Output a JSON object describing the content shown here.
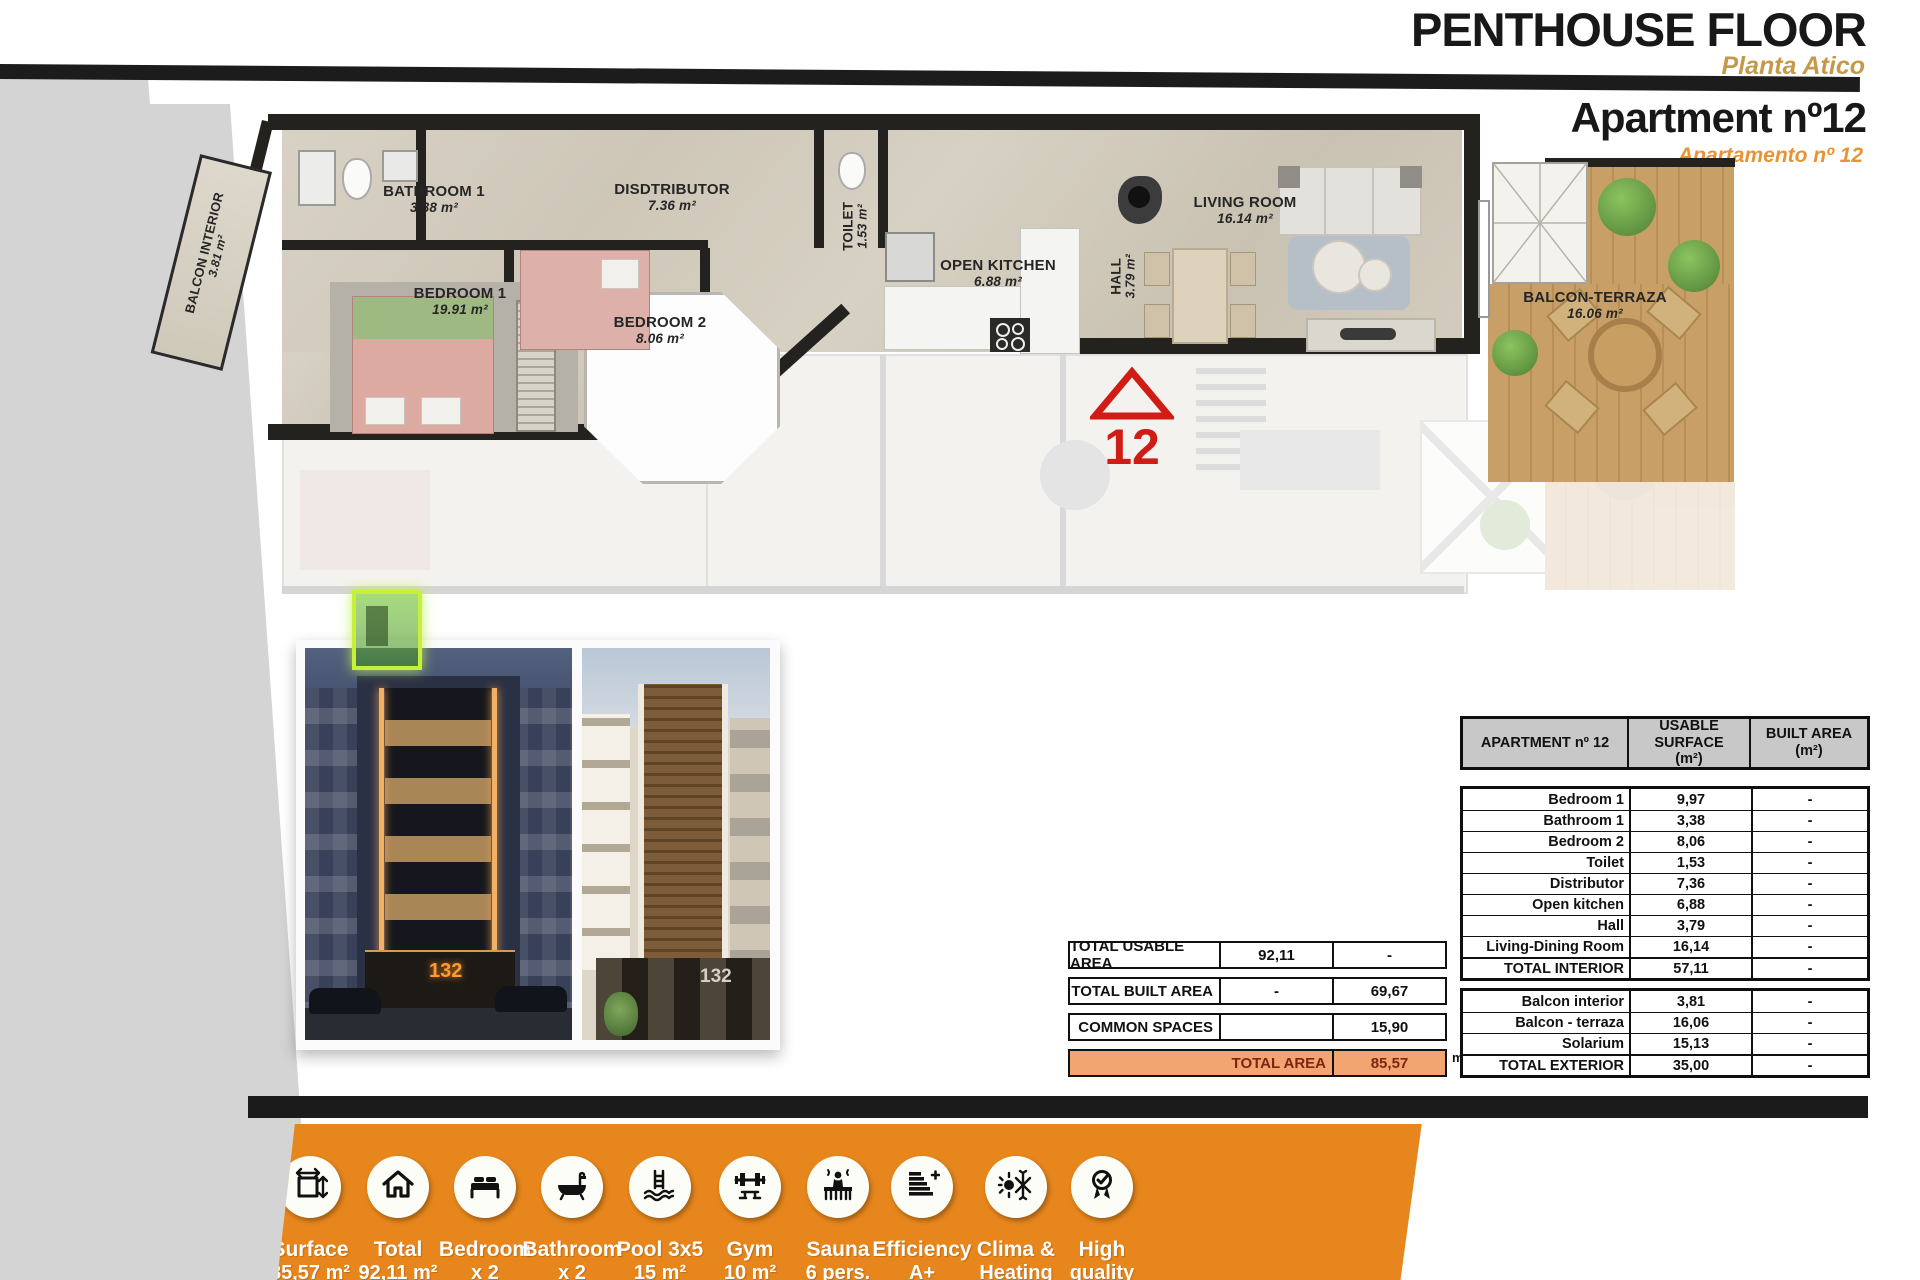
{
  "header": {
    "title": "PENTHOUSE FLOOR",
    "subtitle": "Planta Atico",
    "apartment_title": "Apartment nº12",
    "apartment_subtitle": "Apartamento nº 12"
  },
  "floorplan": {
    "marker": "12",
    "rooms": {
      "balcon_interior": {
        "name": "BALCON INTERIOR",
        "area": "3.81 m²"
      },
      "bathroom1": {
        "name": "BATHROOM 1",
        "area": "3.38 m²"
      },
      "bedroom1": {
        "name": "BEDROOM 1",
        "area": "19.91 m²"
      },
      "distributor": {
        "name": "DISDTRIBUTOR",
        "area": "7.36 m²"
      },
      "bedroom2": {
        "name": "BEDROOM 2",
        "area": "8.06 m²"
      },
      "toilet": {
        "name": "TOILET",
        "area": "1.53 m²"
      },
      "kitchen": {
        "name": "OPEN KITCHEN",
        "area": "6.88 m²"
      },
      "hall": {
        "name": "HALL",
        "area": "3.79 m²"
      },
      "living": {
        "name": "LIVING ROOM",
        "area": "16.14 m²"
      },
      "terraza": {
        "name": "BALCON-TERRAZA",
        "area": "16.06 m²"
      }
    }
  },
  "photos": {
    "left_badge": "132",
    "right_badge": "132"
  },
  "summary": {
    "rows": [
      {
        "label": "TOTAL USABLE AREA",
        "c1": "92,11",
        "c2": "-"
      },
      {
        "label": "TOTAL BUILT AREA",
        "c1": "-",
        "c2": "69,67"
      },
      {
        "label": "COMMON SPACES",
        "c1": "",
        "c2": "15,90"
      }
    ],
    "total_label": "TOTAL AREA",
    "total_value": "85,57",
    "total_unit": "m²"
  },
  "area_table": {
    "title": "APARTMENT nº 12",
    "col_usable_1": "USABLE SURFACE",
    "col_usable_2": "(m²)",
    "col_built_1": "BUILT AREA",
    "col_built_2": "(m²)",
    "interior": [
      {
        "label": "Bedroom 1",
        "usable": "9,97",
        "built": "-"
      },
      {
        "label": "Bathroom 1",
        "usable": "3,38",
        "built": "-"
      },
      {
        "label": "Bedroom 2",
        "usable": "8,06",
        "built": "-"
      },
      {
        "label": "Toilet",
        "usable": "1,53",
        "built": "-"
      },
      {
        "label": "Distributor",
        "usable": "7,36",
        "built": "-"
      },
      {
        "label": "Open kitchen",
        "usable": "6,88",
        "built": "-"
      },
      {
        "label": "Hall",
        "usable": "3,79",
        "built": "-"
      },
      {
        "label": "Living-Dining Room",
        "usable": "16,14",
        "built": "-"
      },
      {
        "label": "TOTAL INTERIOR",
        "usable": "57,11",
        "built": "-"
      }
    ],
    "exterior": [
      {
        "label": "Balcon interior",
        "usable": "3,81",
        "built": "-"
      },
      {
        "label": "Balcon - terraza",
        "usable": "16,06",
        "built": "-"
      },
      {
        "label": "Solarium",
        "usable": "15,13",
        "built": "-"
      },
      {
        "label": "TOTAL EXTERIOR",
        "usable": "35,00",
        "built": "-"
      }
    ]
  },
  "features": [
    {
      "icon": "surface-icon",
      "line1": "Surface",
      "line2": "85,57 m²"
    },
    {
      "icon": "house-icon",
      "line1": "Total",
      "line2": "92,11 m²"
    },
    {
      "icon": "bed-icon",
      "line1": "Bedroom",
      "line2": "x 2"
    },
    {
      "icon": "bathtub-icon",
      "line1": "Bathroom",
      "line2": "x 2"
    },
    {
      "icon": "pool-icon",
      "line1": "Pool 3x5",
      "line2": "15 m²"
    },
    {
      "icon": "gym-icon",
      "line1": "Gym",
      "line2": "10 m²"
    },
    {
      "icon": "sauna-icon",
      "line1": "Sauna",
      "line2": "6 pers."
    },
    {
      "icon": "efficiency-icon",
      "line1": "Efficiency",
      "line2": "A+"
    },
    {
      "icon": "climate-icon",
      "line1": "Clima &",
      "line2": "Heating"
    },
    {
      "icon": "quality-icon",
      "line1": "High",
      "line2": "quality"
    }
  ],
  "colors": {
    "accent_orange": "#e7861c",
    "subtitle_tan": "#c49a4a",
    "subtitle_orange": "#e89434",
    "marker_red": "#cf1d15",
    "total_row_fill": "#f2a571",
    "header_gray": "#c8c8c8"
  }
}
